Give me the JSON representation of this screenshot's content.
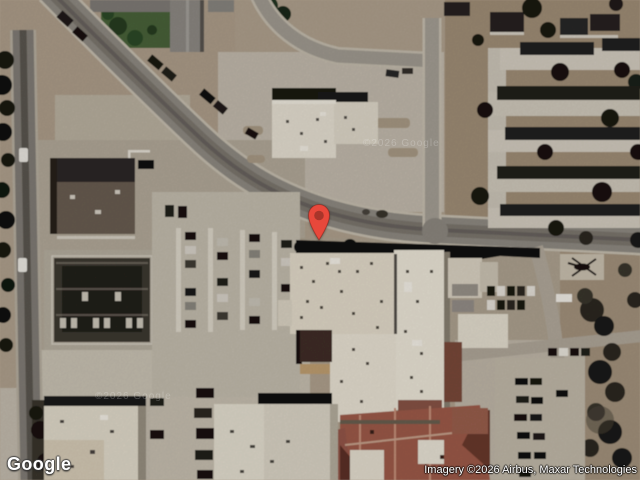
{
  "map": {
    "view_type": "satellite",
    "branding": {
      "logo_text": "Google"
    },
    "attribution": {
      "text": "Imagery ©2026 Airbus, Maxar Technologies"
    },
    "watermarks": [
      {
        "text": "©2026 Google"
      },
      {
        "text": "©2026 Google"
      }
    ],
    "marker": {
      "icon": "map-pin-icon",
      "color": "#E8483B",
      "inner_color": "#A8352A",
      "outline_color": "#8E2A1F",
      "x": 319,
      "y": 240
    },
    "imagery_palette": {
      "ground": "#b2a390",
      "dirt_dark": "#a29078",
      "pavement": "#c6bdb0",
      "road": "#918c84",
      "roof_light": "#e8e1d2",
      "roof_dark": "#23211f",
      "roof_tile": "#a05c4a",
      "vegetation": "#4a653b",
      "shadow": "#131110"
    }
  }
}
